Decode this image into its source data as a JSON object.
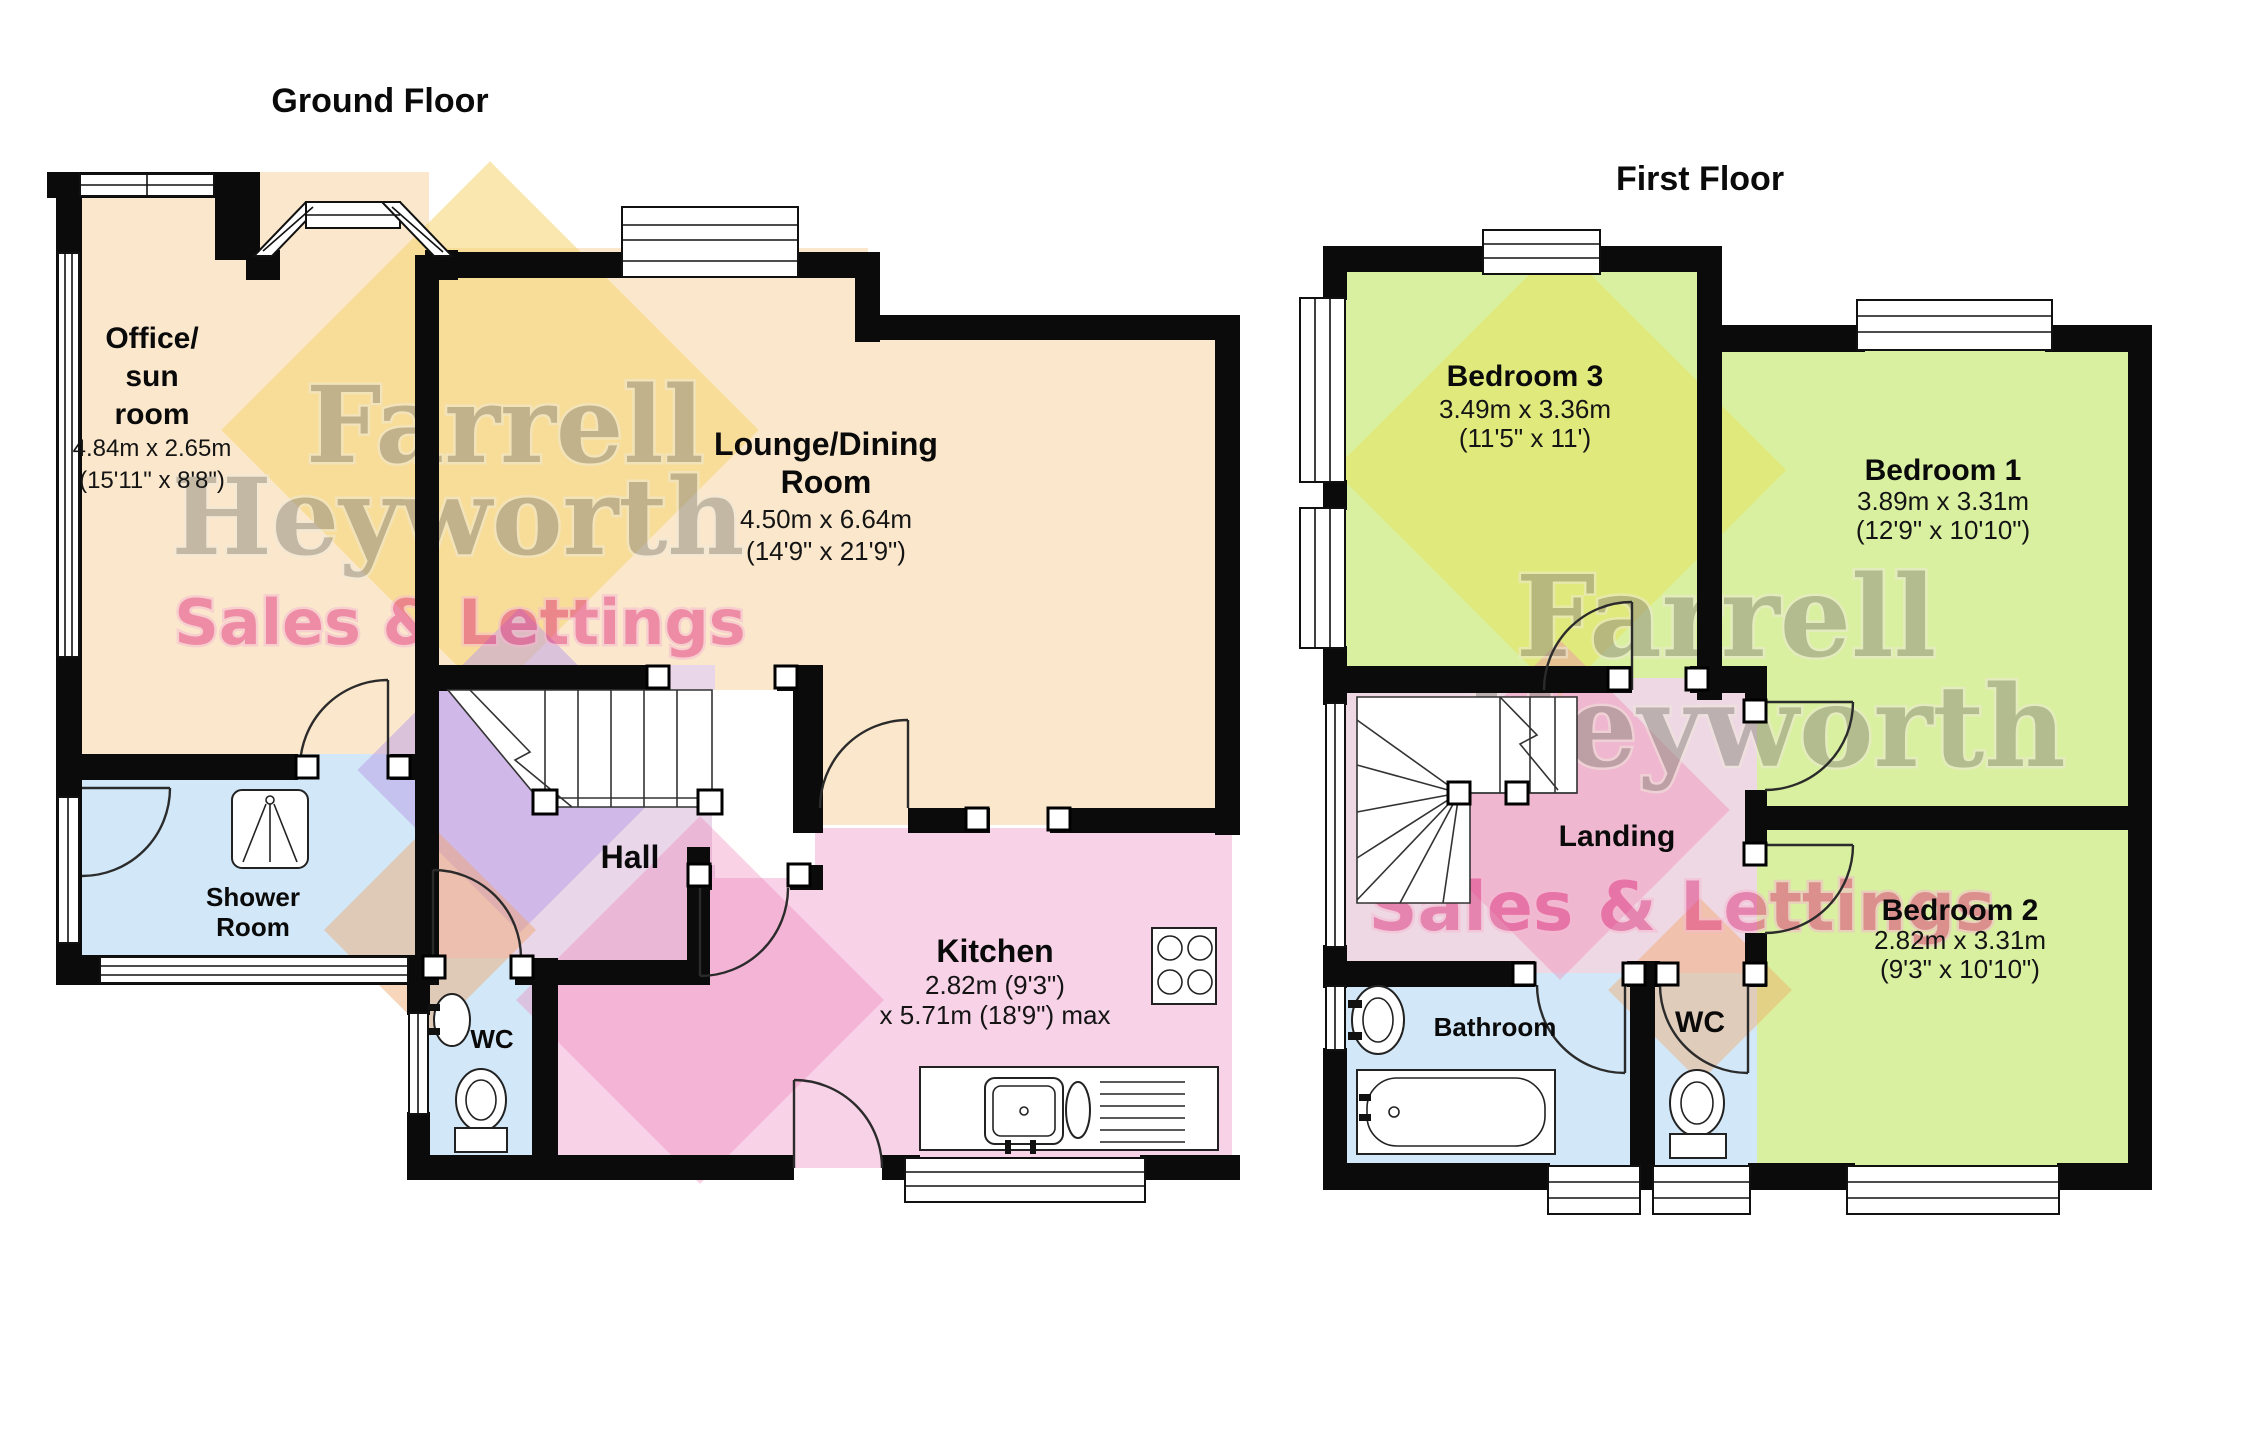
{
  "ground_floor": {
    "title": "Ground Floor",
    "rooms": {
      "office": {
        "name_line1": "Office/",
        "name_line2": "sun",
        "name_line3": "room",
        "dims_metric": "4.84m x 2.65m",
        "dims_imperial": "(15'11\" x 8'8\")"
      },
      "lounge": {
        "name_line1": "Lounge/Dining",
        "name_line2": "Room",
        "dims_metric": "4.50m x 6.64m",
        "dims_imperial": "(14'9\" x 21'9\")"
      },
      "shower_room": {
        "name_line1": "Shower",
        "name_line2": "Room"
      },
      "hall": {
        "name": "Hall"
      },
      "wc": {
        "name": "WC"
      },
      "kitchen": {
        "name": "Kitchen",
        "dims_metric": "2.82m (9'3\")",
        "dims_imperial": "x 5.71m (18'9\") max"
      }
    }
  },
  "first_floor": {
    "title": "First Floor",
    "rooms": {
      "bedroom3": {
        "name": "Bedroom 3",
        "dims_metric": "3.49m x 3.36m",
        "dims_imperial": "(11'5\" x 11')"
      },
      "bedroom1": {
        "name": "Bedroom 1",
        "dims_metric": "3.89m x 3.31m",
        "dims_imperial": "(12'9\" x 10'10\")"
      },
      "bedroom2": {
        "name": "Bedroom 2",
        "dims_metric": "2.82m x 3.31m",
        "dims_imperial": "(9'3\" x 10'10\")"
      },
      "landing": {
        "name": "Landing"
      },
      "bathroom": {
        "name": "Bathroom"
      },
      "wc": {
        "name": "WC"
      }
    }
  },
  "watermark": {
    "brand_line1": "Farrell",
    "brand_line2": "Heyworth",
    "tagline": "Sales & Lettings"
  },
  "colors": {
    "wall": "#0b0b0b",
    "room_cream": "#fbe8cc",
    "room_blue": "#d2e8f8",
    "room_pink": "#f8d2e7",
    "room_lavender": "#e9d6e9",
    "room_landing": "#eed8e3",
    "room_green": "#d9f0a0",
    "accent_yellow": "#f6d470",
    "accent_purple": "#b79ce8",
    "accent_orange": "#f0a468",
    "accent_pink": "#ee7fb5",
    "watermark_gray": "#8d897e",
    "watermark_pink": "#e0337e"
  }
}
